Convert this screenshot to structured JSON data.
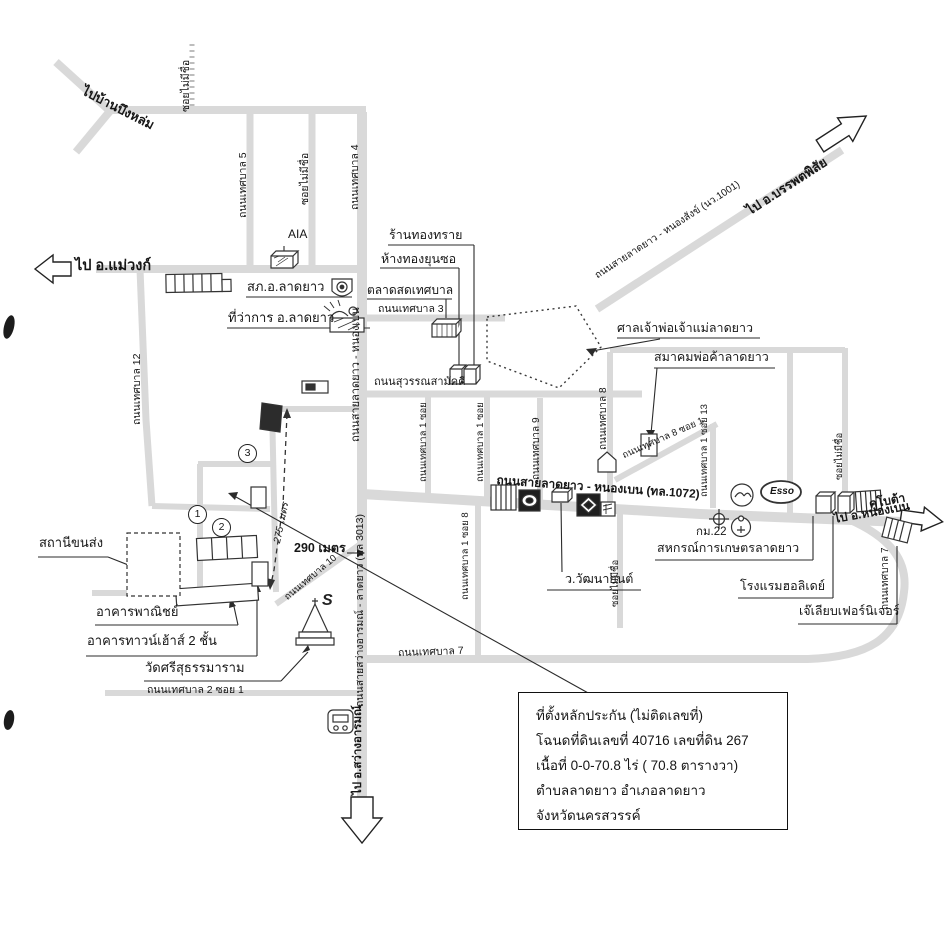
{
  "map": {
    "directions": {
      "mae_wong": "ไป อ.แม่วงก์",
      "banphot": "ไป อ.บรรพตพิสัย",
      "nong_ben": "ไป อ.หนองเบน",
      "sawang": "ไป อ.สว่างอารมณ์",
      "bueng_lom": "ไปบ้านบึงหล่ม"
    },
    "roads": {
      "no_name_soi": "ซอยไม่มีชื่อ",
      "tessaban_5": "ถนนเทศบาล 5",
      "tessaban_4": "ถนนเทศบาล 4",
      "tessaban_12": "ถนนเทศบาล 12",
      "tessaban_3": "ถนนเทศบาล 3",
      "suwan_samakkhi": "ถนนสุวรรณสามัคคี",
      "tessaban_9": "ถนนเทศบาล 9",
      "tessaban_8": "ถนนเทศบาล 8",
      "tessaban_8_soi_1": "ถนนเทศบาล 8 ซอย 1",
      "tessaban_1_soi": "ถนนเทศบาล 1 ซอย",
      "tessaban_1_soi_8": "ถนนเทศบาล 1 ซอย 8",
      "tessaban_1_soi_13": "ถนนเทศบาล 1 ซอย 13",
      "tessaban_7": "ถนนเทศบาล 7",
      "tessaban_2_soi_1": "ถนนเทศบาล 2 ซอย 1",
      "tessaban_10": "ถนนเทศบาล 10",
      "main_1072": "ถนนสายลาดยาว - หนองเบน (ทล.1072)",
      "ladyao_nongben": "ถนนสายลาดยาว - หนองเบน",
      "sawang_ladyao": "ถนนสายสว่างอารมณ์ - ลาดยาว (ทล 3013)",
      "ladyao_nongsang": "ถนนสายลาดยาว - หนองสังข์ (นว.1001)"
    },
    "places": {
      "police": "สภ.อ.ลาดยาว",
      "district_office": "ที่ว่าการ อ.ลาดยาว",
      "fresh_market": "ตลาดสดเทศบาล",
      "gold_shop_1": "ร้านทองทราย",
      "gold_shop_2": "ห้างทองยุนซอ",
      "shrine": "ศาลเจ้าพ่อเจ้าแม่ลาดยาว",
      "merchant_assoc": "สมาคมพ่อค้าลาดยาว",
      "coop": "สหกรณ์การเกษตรลาดยาว",
      "holiday_hotel": "โรงแรมฮอลิเดย์",
      "furniture_shop": "เจ๊เลียบเฟอร์นิเจอร์",
      "watthana_garage": "ว.วัฒนายนต์",
      "bus_terminal": "สถานีขนส่ง",
      "commercial_bldg": "อาคารพาณิชย์",
      "townhouse": "อาคารทาวน์เฮ้าส์ 2 ชั้น",
      "temple": "วัดศรีสุธรรมาราม"
    },
    "markers": {
      "aia": "AIA",
      "esso": "Esso",
      "km22": "กม.22",
      "kubota": "คูโบต้า",
      "suzuki": "S"
    },
    "distances": {
      "d290": "290 เมตร",
      "d275": "275 เมตร"
    },
    "plot_numbers": [
      "1",
      "2",
      "3"
    ],
    "info_box": {
      "line1": "ที่ตั้งหลักประกัน (ไม่ติดเลขที่)",
      "line2": "โฉนดที่ดินเลขที่ 40716  เลขที่ดิน 267",
      "line3": "เนื้อที่ 0-0-70.8  ไร่ ( 70.8 ตารางวา)",
      "line4": "ตำบลลาดยาว  อำเภอลาดยาว",
      "line5": "จังหวัดนครสวรรค์"
    }
  }
}
